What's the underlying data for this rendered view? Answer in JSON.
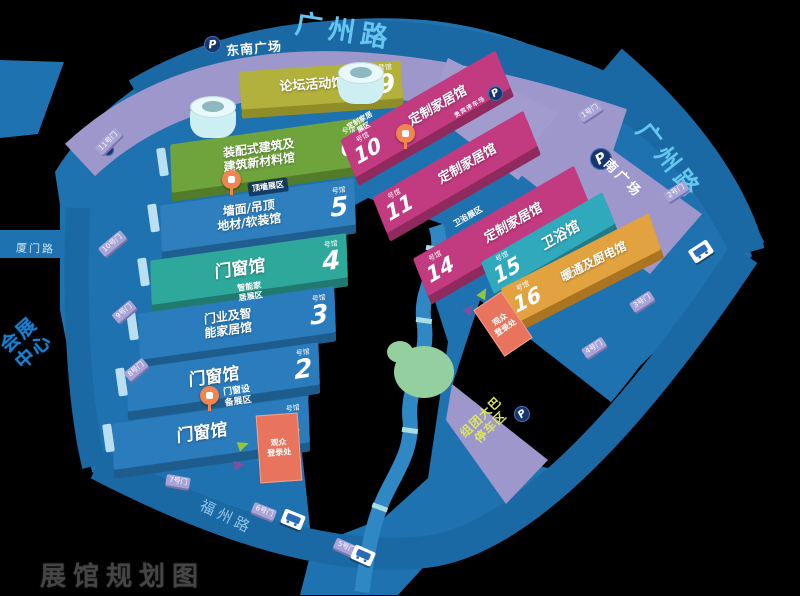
{
  "watermark": "展馆规划图",
  "landmark": {
    "line1": "会展",
    "line2": "中心"
  },
  "parking_icon": "P",
  "roads": {
    "top": "广州路",
    "right": "广州路",
    "left": "厦门路",
    "bottom": "福州路"
  },
  "plazas": {
    "southeast": "东南广场",
    "south": "南广场",
    "vip": "贵宾停车场",
    "bus_line1": "组团大巴",
    "bus_line2": "停车区"
  },
  "halls": [
    {
      "name": "门窗馆",
      "num": "1",
      "unit": "号馆"
    },
    {
      "name": "门窗馆",
      "num": "2",
      "unit": "号馆"
    },
    {
      "name1": "门业及智",
      "name2": "能家居馆",
      "num": "3",
      "unit": "号馆"
    },
    {
      "name": "门窗馆",
      "num": "4",
      "unit": "号馆"
    },
    {
      "name1": "墙面/吊顶",
      "name2": "地材/软装馆",
      "num": "5",
      "unit": "号馆"
    },
    {
      "name1": "装配式建筑及",
      "name2": "建筑新材料馆",
      "num": "6",
      "unit": "号馆"
    },
    {
      "name": "论坛活动馆",
      "num": "9",
      "unit": "号馆"
    },
    {
      "name": "定制家居馆",
      "num": "10",
      "unit": "号馆"
    },
    {
      "name": "定制家居馆",
      "num": "11",
      "unit": "号馆"
    },
    {
      "name": "定制家居馆",
      "num": "14",
      "unit": "号馆"
    },
    {
      "name": "卫浴馆",
      "num": "15",
      "unit": "号馆"
    },
    {
      "name": "暖通及厨电馆",
      "num": "16",
      "unit": "号馆"
    }
  ],
  "zones": {
    "ceiling": "顶墙展区",
    "smart1": "智能家",
    "smart2": "居展区",
    "equip1": "门窗设",
    "equip2": "备展区",
    "custom1": "定制家居",
    "custom2": "展区",
    "bath": "卫浴展区"
  },
  "registration": {
    "line1": "观众",
    "line2": "登录处"
  },
  "gates": [
    "1号门",
    "2号门",
    "3号门",
    "4号门",
    "5号门",
    "6号门",
    "7号门",
    "8号门",
    "9号门",
    "10号门",
    "11号门"
  ],
  "colors": {
    "background": "#000000",
    "base_blue": "#1e72b0",
    "road_blue": "#1a68a4",
    "plaza_purple": "#9e97cb",
    "hall_blue": "#2b7cbc",
    "hall_teal": "#2fa89c",
    "hall_green": "#6fa33c",
    "hall_olive": "#b2b13c",
    "hall_magenta": "#c23a80",
    "hall_cyan": "#2fa9bb",
    "hall_orange": "#e2a23f",
    "registration_red": "#e8745e",
    "arrow_green": "#8ec63f",
    "arrow_purple": "#7b52a3",
    "pin_orange": "#f0854f",
    "tree_green": "#94cf9f",
    "road_label": "#66c6f0"
  }
}
